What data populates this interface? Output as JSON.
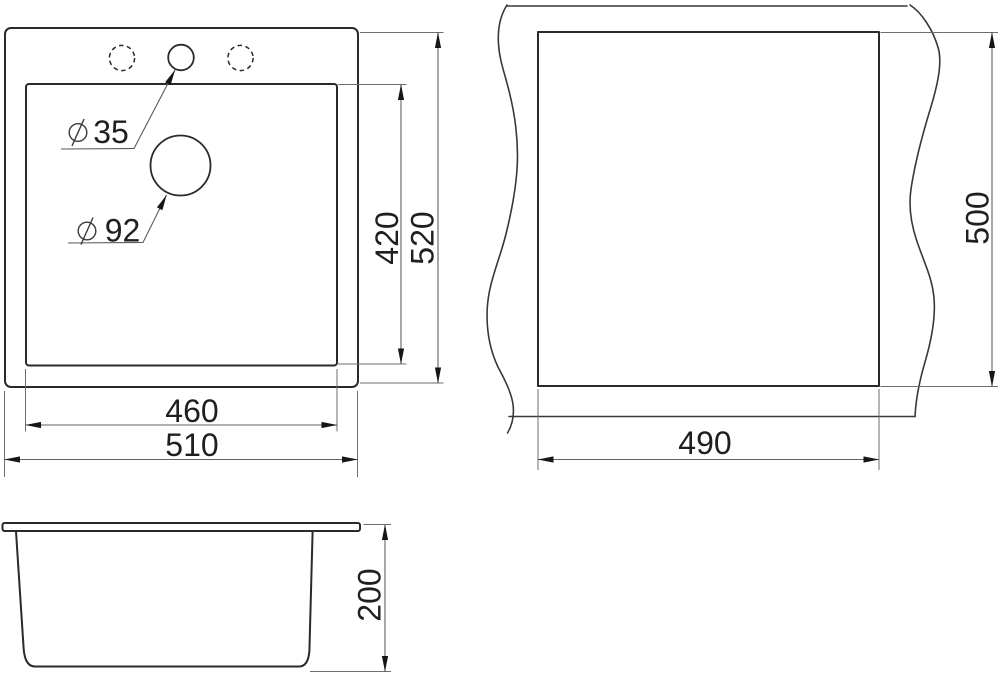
{
  "drawing": {
    "description": "Sink installation dimension drawing with three views",
    "colors": {
      "background": "#ffffff",
      "outline": "#2a2a2a",
      "dimension_line": "#616161",
      "text": "#1f1f1f"
    },
    "views": {
      "top": {
        "label": "top-view-of-sink",
        "outer_width_mm": "510",
        "inner_width_mm": "460",
        "outer_height_mm": "520",
        "inner_height_mm": "420",
        "faucet_hole_diameter_mm": "35",
        "drain_hole_diameter_mm": "92"
      },
      "cutout": {
        "label": "countertop-cutout-view",
        "width_mm": "490",
        "height_mm": "500"
      },
      "side": {
        "label": "side-view-of-bowl",
        "depth_mm": "200"
      }
    }
  }
}
